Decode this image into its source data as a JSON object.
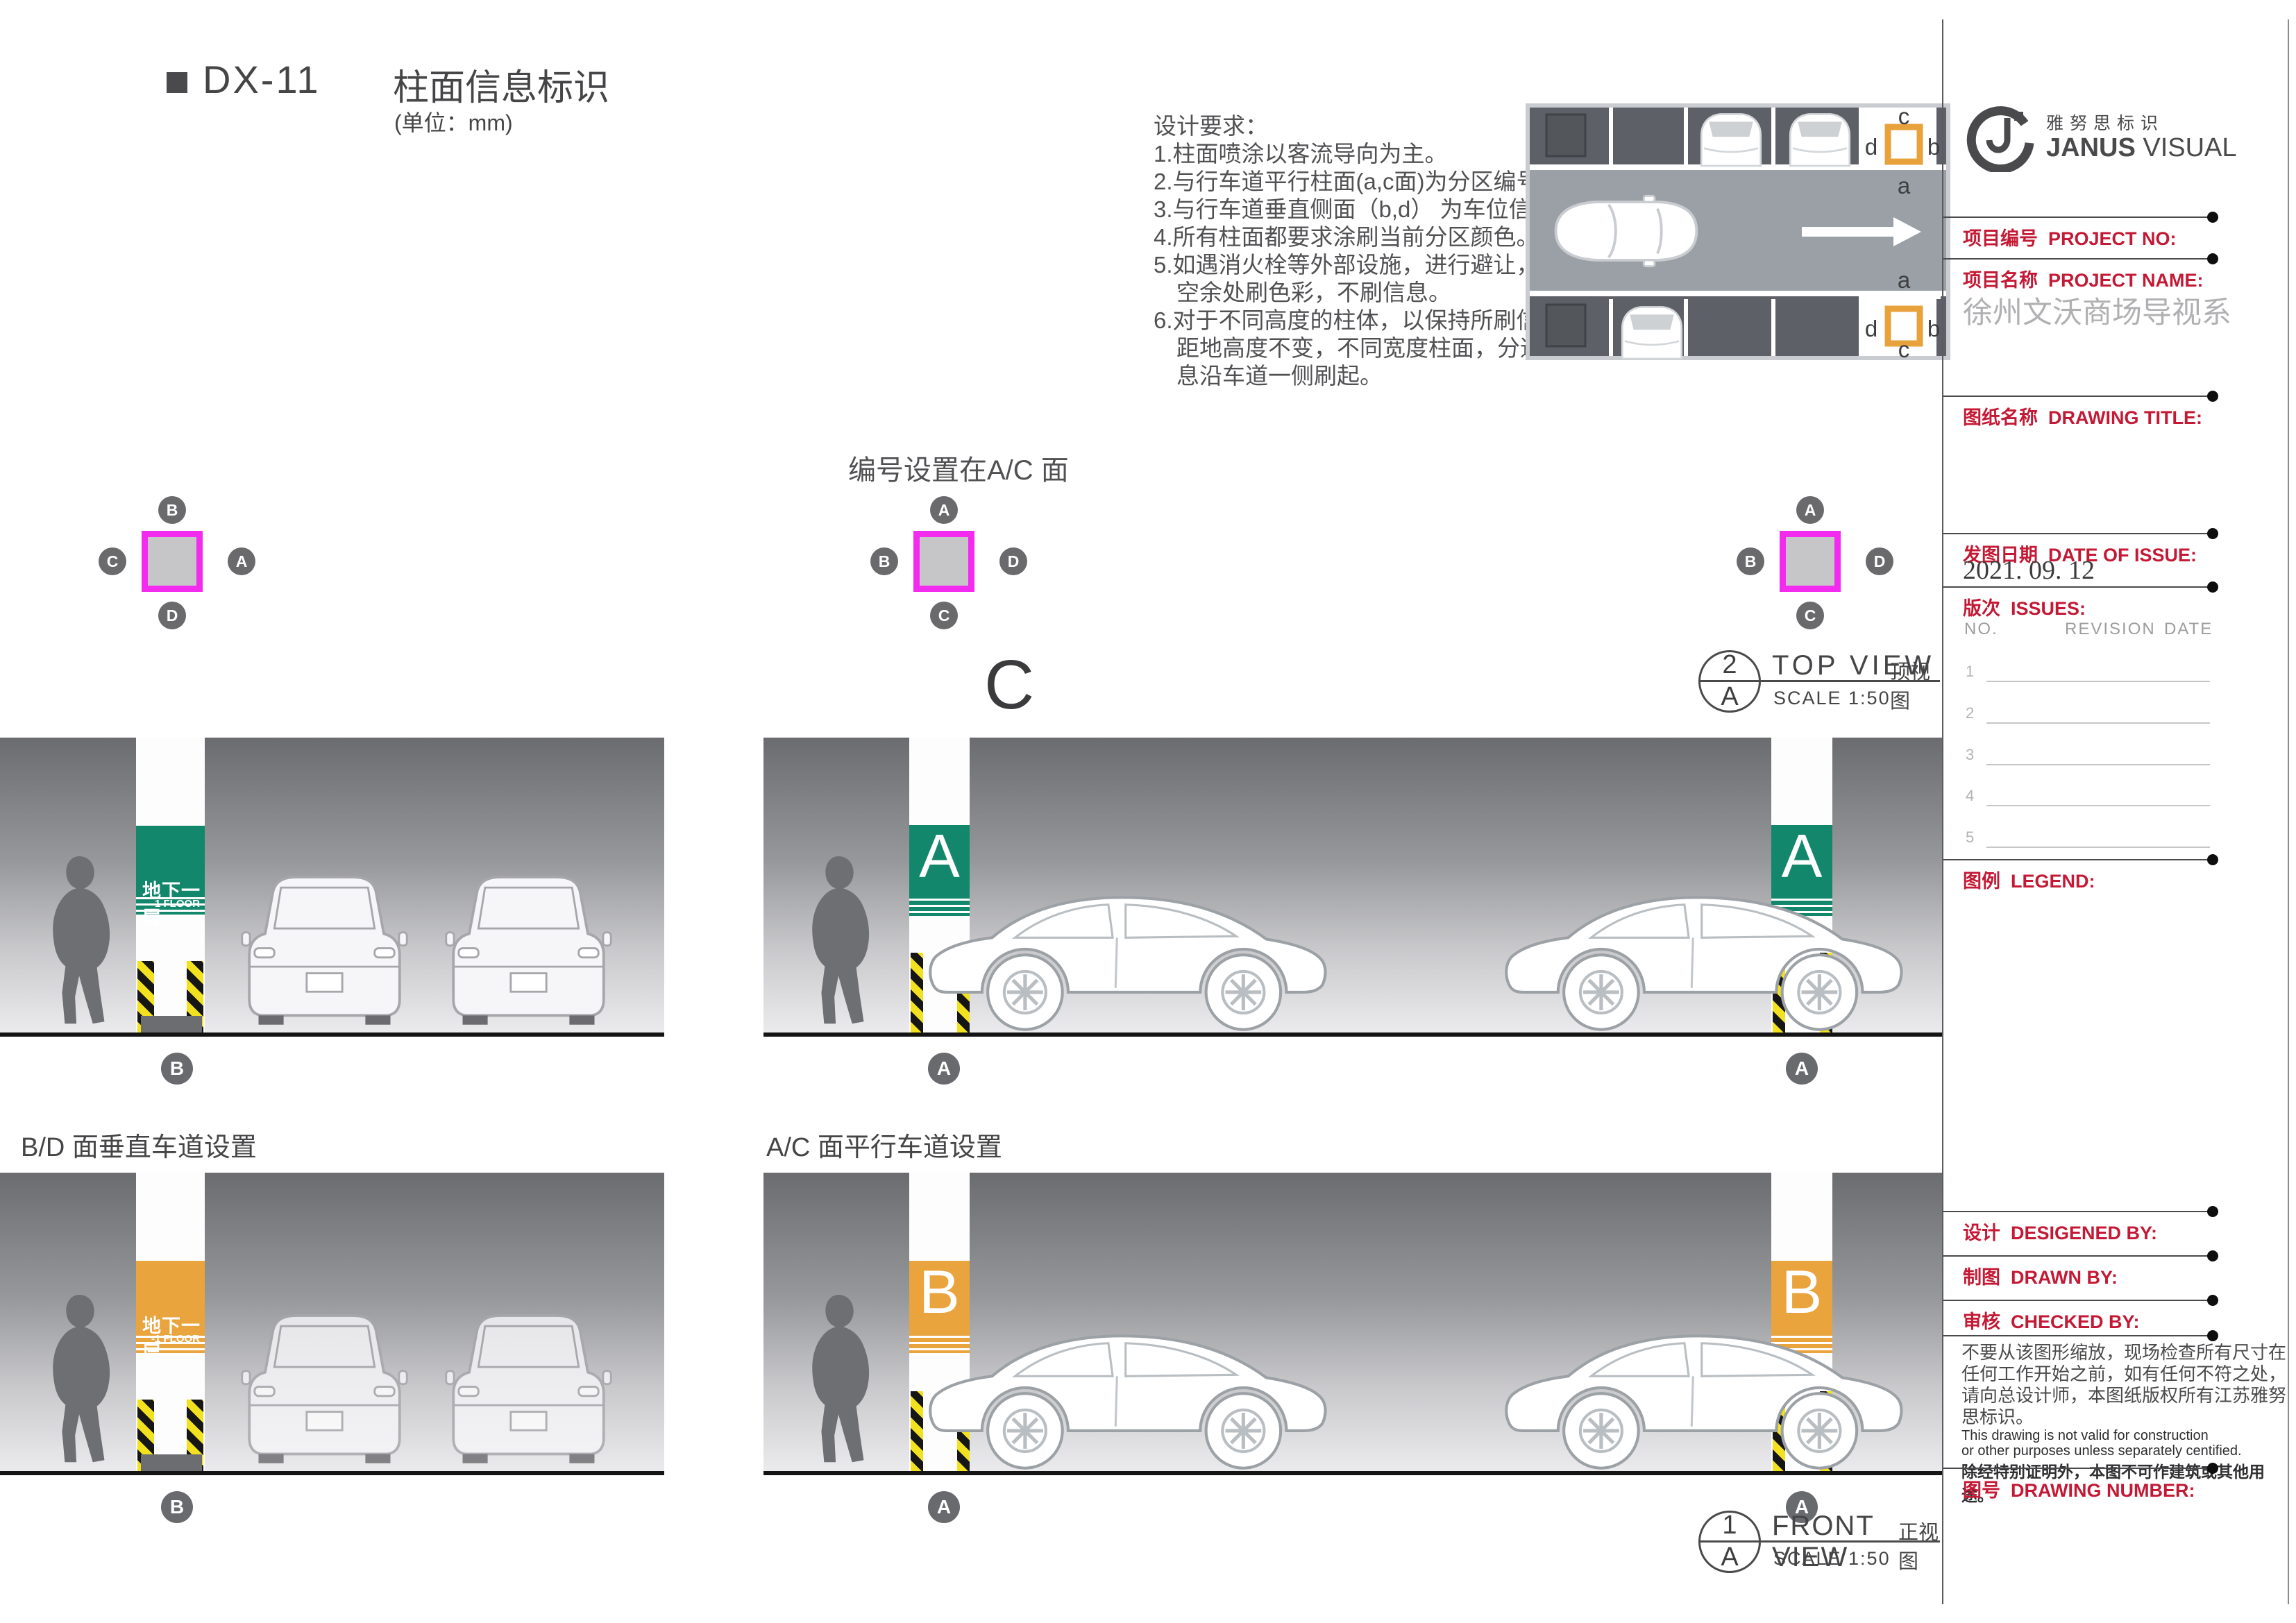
{
  "header": {
    "code": "DX-11",
    "title": "柱面信息标识",
    "unit": "(单位：mm)"
  },
  "notes": {
    "title": "设计要求：",
    "lines": [
      "1.柱面喷涂以客流导向为主。",
      "2.与行车道平行柱面(a,c面)为分区编号",
      "3.与行车道垂直侧面（b,d） 为车位信息。",
      "4.所有柱面都要求涂刷当前分区颜色。",
      "5.如遇消火栓等外部设施，进行避让，在",
      "　空余处刷色彩，不刷信息。",
      "6.对于不同高度的柱体，以保持所刷信息",
      "　距地高度不变，不同宽度柱面，分道信",
      "　息沿车道一侧刷起。"
    ]
  },
  "plan": {
    "top_col": {
      "top": "c",
      "left": "d",
      "right": "b",
      "bottom": "a"
    },
    "bottom_col": {
      "top": "a",
      "left": "d",
      "right": "b",
      "bottom": "c"
    }
  },
  "axis": {
    "caption": "编号设置在A/C 面",
    "big_letter": "C",
    "squares": [
      {
        "top": "B",
        "left": "C",
        "right": "A",
        "bottom": "D"
      },
      {
        "top": "A",
        "left": "B",
        "right": "D",
        "bottom": "C"
      },
      {
        "top": "A",
        "left": "B",
        "right": "D",
        "bottom": "C"
      }
    ]
  },
  "views": {
    "top": {
      "num": "2",
      "ref": "A",
      "title": "TOP VIEW",
      "title_cn": "顶视图",
      "scale": "SCALE 1:50"
    },
    "front": {
      "num": "1",
      "ref": "A",
      "title": "FRONT VIEW",
      "title_cn": "正视图",
      "scale": "SCALE 1:50"
    }
  },
  "sections": {
    "bd_label": "B/D 面垂直车道设置",
    "ac_label": "A/C 面平行车道设置"
  },
  "signs": {
    "floor_cn": "地下一层",
    "floor_en": "-1 FLOOR",
    "zone_a": "A",
    "zone_b": "B"
  },
  "markers": {
    "a": "A",
    "b": "B"
  },
  "titleblock": {
    "brand_cn": "雅努思标识",
    "brand_en_bold": "JANUS",
    "brand_en_rest": " VISUAL",
    "project_no_label": "项目编号  PROJECT NO:",
    "project_name_label": "项目名称  PROJECT NAME:",
    "project_name": "徐州文沃商场导视系",
    "drawing_title_label": "图纸名称  DRAWING TITLE:",
    "date_label": "发图日期  DATE OF ISSUE:",
    "date": "2021. 09. 12",
    "issues_label": "版次  ISSUES:",
    "rev_headers": [
      "NO.",
      "REVISION",
      "DATE"
    ],
    "rev_rows": [
      "1",
      "2",
      "3",
      "4",
      "5"
    ],
    "legend_label": "图例  LEGEND:",
    "designed_label": "设计  DESIGENED BY:",
    "drawn_label": "制图  DRAWN BY:",
    "checked_label": "审核  CHECKED BY:",
    "disclaimer_cn": [
      "不要从该图形缩放，现场检查所有尺寸在",
      "任何工作开始之前，如有任何不符之处，",
      "请向总设计师，本图纸版权所有江苏雅努",
      "思标识。"
    ],
    "disclaimer_en": [
      "This drawing is not valid for construction",
      "or other purposes unless separately centified."
    ],
    "disclaimer_cn2": "除经特别证明外，本图不可作建筑或其他用途。",
    "drawing_number_label": "图号  DRAWING NUMBER:"
  },
  "colors": {
    "zone_green": "#13876C",
    "zone_orange": "#E9A43E",
    "column_magenta": "#F22BEF",
    "titleblock_red": "#C41935",
    "hazard_yellow": "#F2E11F",
    "dark_gray": "#4A4A4C"
  }
}
